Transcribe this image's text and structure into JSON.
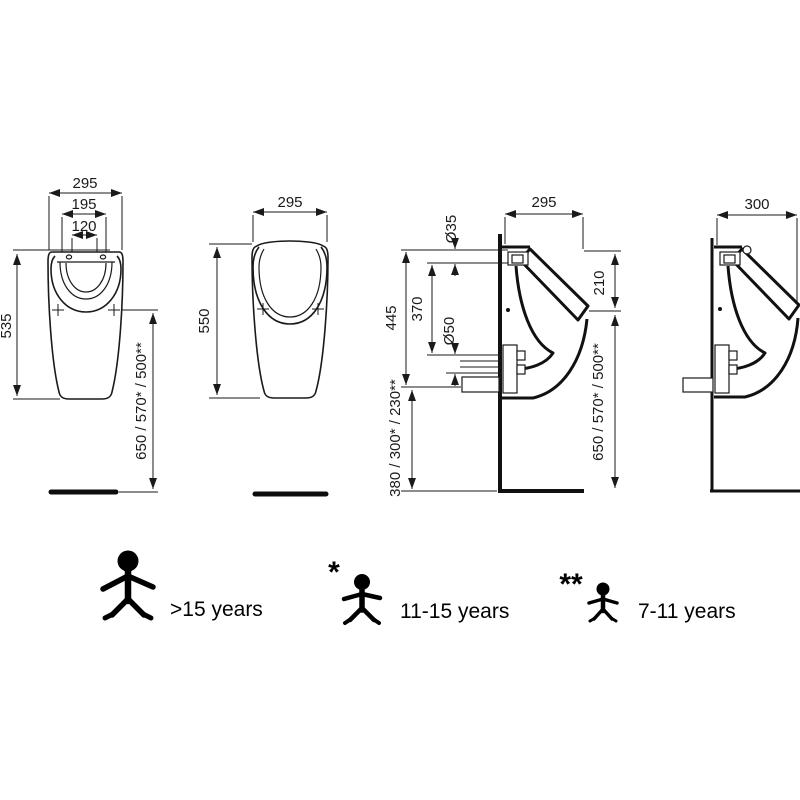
{
  "views": {
    "front_small": {
      "dim_width": "295",
      "dim_rim_width": "195",
      "dim_hole_spacing": "120",
      "dim_height": "535",
      "dim_rim_to_floor": "650 / 570* / 500**"
    },
    "front_large": {
      "dim_width": "295",
      "dim_height": "550"
    },
    "side_detail": {
      "dim_width": "295",
      "dim_inlet_diameter": "Ø35",
      "dim_spout_drop": "210",
      "dim_inlet_to_outlet": "370",
      "dim_outlet_diameter": "Ø50",
      "dim_rim_height": "445",
      "dim_spout_to_floor": "650 / 570* / 500**",
      "dim_outlet_to_floor": "380 / 300* / 230**"
    },
    "side_plain": {
      "dim_width": "300"
    }
  },
  "legend": {
    "adult": {
      "label": ">15 years"
    },
    "teen": {
      "marker": "*",
      "label": "11-15 years"
    },
    "child": {
      "marker": "**",
      "label": "7-11 years"
    }
  },
  "colors": {
    "line": "#1a1a1a",
    "figure": "#000000",
    "background": "#ffffff"
  }
}
